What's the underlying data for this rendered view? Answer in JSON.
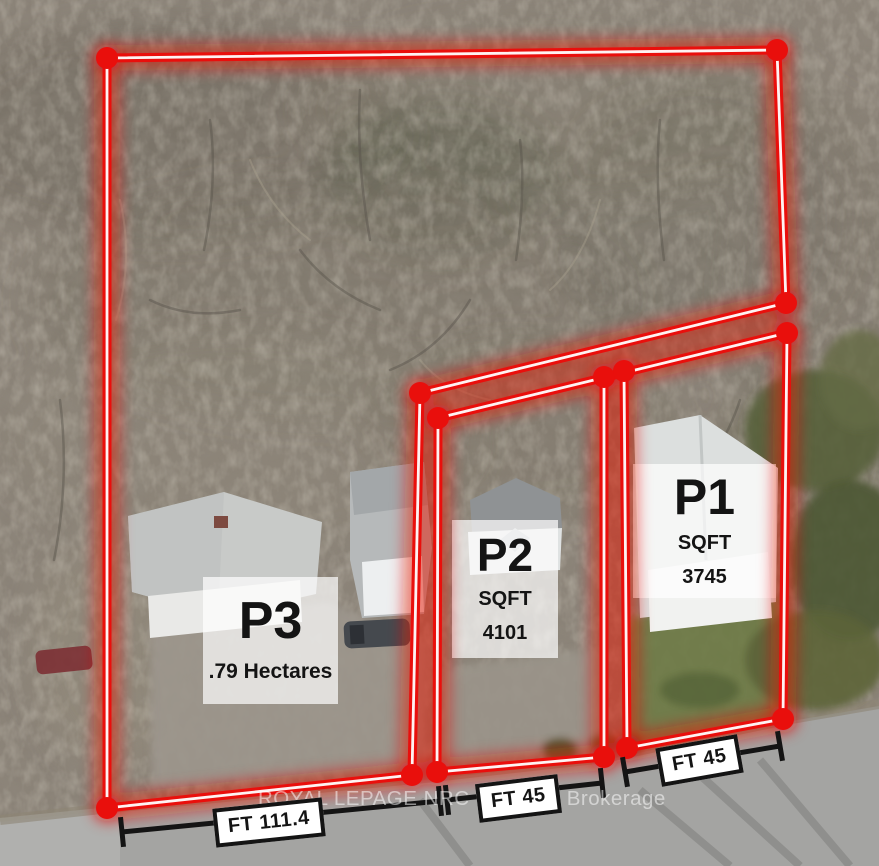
{
  "parcels": {
    "p1": {
      "title": "P1",
      "unit": "SQFT",
      "value": "3745"
    },
    "p2": {
      "title": "P2",
      "unit": "SQFT",
      "value": "4101"
    },
    "p3": {
      "title": "P3",
      "area": ".79 Hectares"
    }
  },
  "measurements": {
    "p3_frontage": "FT 111.4",
    "p2_frontage": "FT 45",
    "p1_frontage": "FT 45"
  },
  "watermark": {
    "text": "ROYAL LEPAGE NRC REALTY, Brokerage"
  },
  "colors": {
    "boundary_red": "#e90f0c",
    "line_core": "#ffffff",
    "measure_black": "#141414",
    "label_bg": "#ffffff",
    "label_text": "#141414",
    "watermark_white": "rgba(255,255,255,0.52)"
  }
}
